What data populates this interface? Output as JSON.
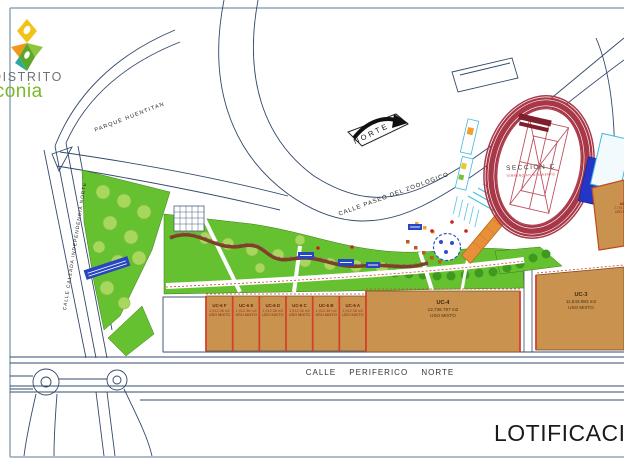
{
  "logo": {
    "top": "DISTRITO",
    "bottom": "iconia"
  },
  "compass": {
    "label": "NORTE"
  },
  "streets": {
    "left": "CALLE CALZADA INDEPENDENCIA NORTE",
    "top": "CALLE PASEO DEL ZOOLOGICO",
    "bottom": "CALLE PERIFERICO NORTE",
    "park": "PARQUE HUENTITAN"
  },
  "stadium": {
    "label": "SECCION C",
    "sublabel": "TERRENO AYUNTAMIENTO"
  },
  "title": "LOTIFICACIÓN",
  "lots": {
    "uc6": [
      {
        "id": "UC-6 F",
        "area": "1,912.38 m2",
        "use": "USO MIXTO"
      },
      {
        "id": "UC-6 E",
        "area": "1,912.38 m2",
        "use": "USO MIXTO"
      },
      {
        "id": "UC-6 D",
        "area": "1,912.38 m2",
        "use": "USO MIXTO"
      },
      {
        "id": "UC-6 C",
        "area": "1,912.38 m2",
        "use": "USO MIXTO"
      },
      {
        "id": "UC-6 B",
        "area": "1,912.38 m2",
        "use": "USO MIXTO"
      },
      {
        "id": "UC-6 A",
        "area": "1,912.38 m2",
        "use": "USO MIXTO"
      }
    ],
    "uc4": {
      "id": "UC-4",
      "area": "12,736.797 m2",
      "use": "USO MIXTO"
    },
    "uc3": {
      "id": "UC-3",
      "area": "11,843.983 m2",
      "use": "USO MIXTO"
    },
    "uc2": {
      "id": "UC-2",
      "area": "2,734.584 m2",
      "use": "USO MIXTO"
    }
  },
  "colors": {
    "lot_fill": "#C9924E",
    "lot_border": "#D2422A",
    "park_green": "#66C131",
    "tree_light": "#A8D75E",
    "tree_dark": "#3E9A1F",
    "track_red": "#A83848",
    "line_blue": "#33496B",
    "accent_blue": "#2336C8",
    "cyan": "#40B8E0",
    "orange_ramp": "#E89038",
    "path_brown": "#7A4326",
    "page_border": "#8FA6BA",
    "logo_green": "#7AB829"
  }
}
